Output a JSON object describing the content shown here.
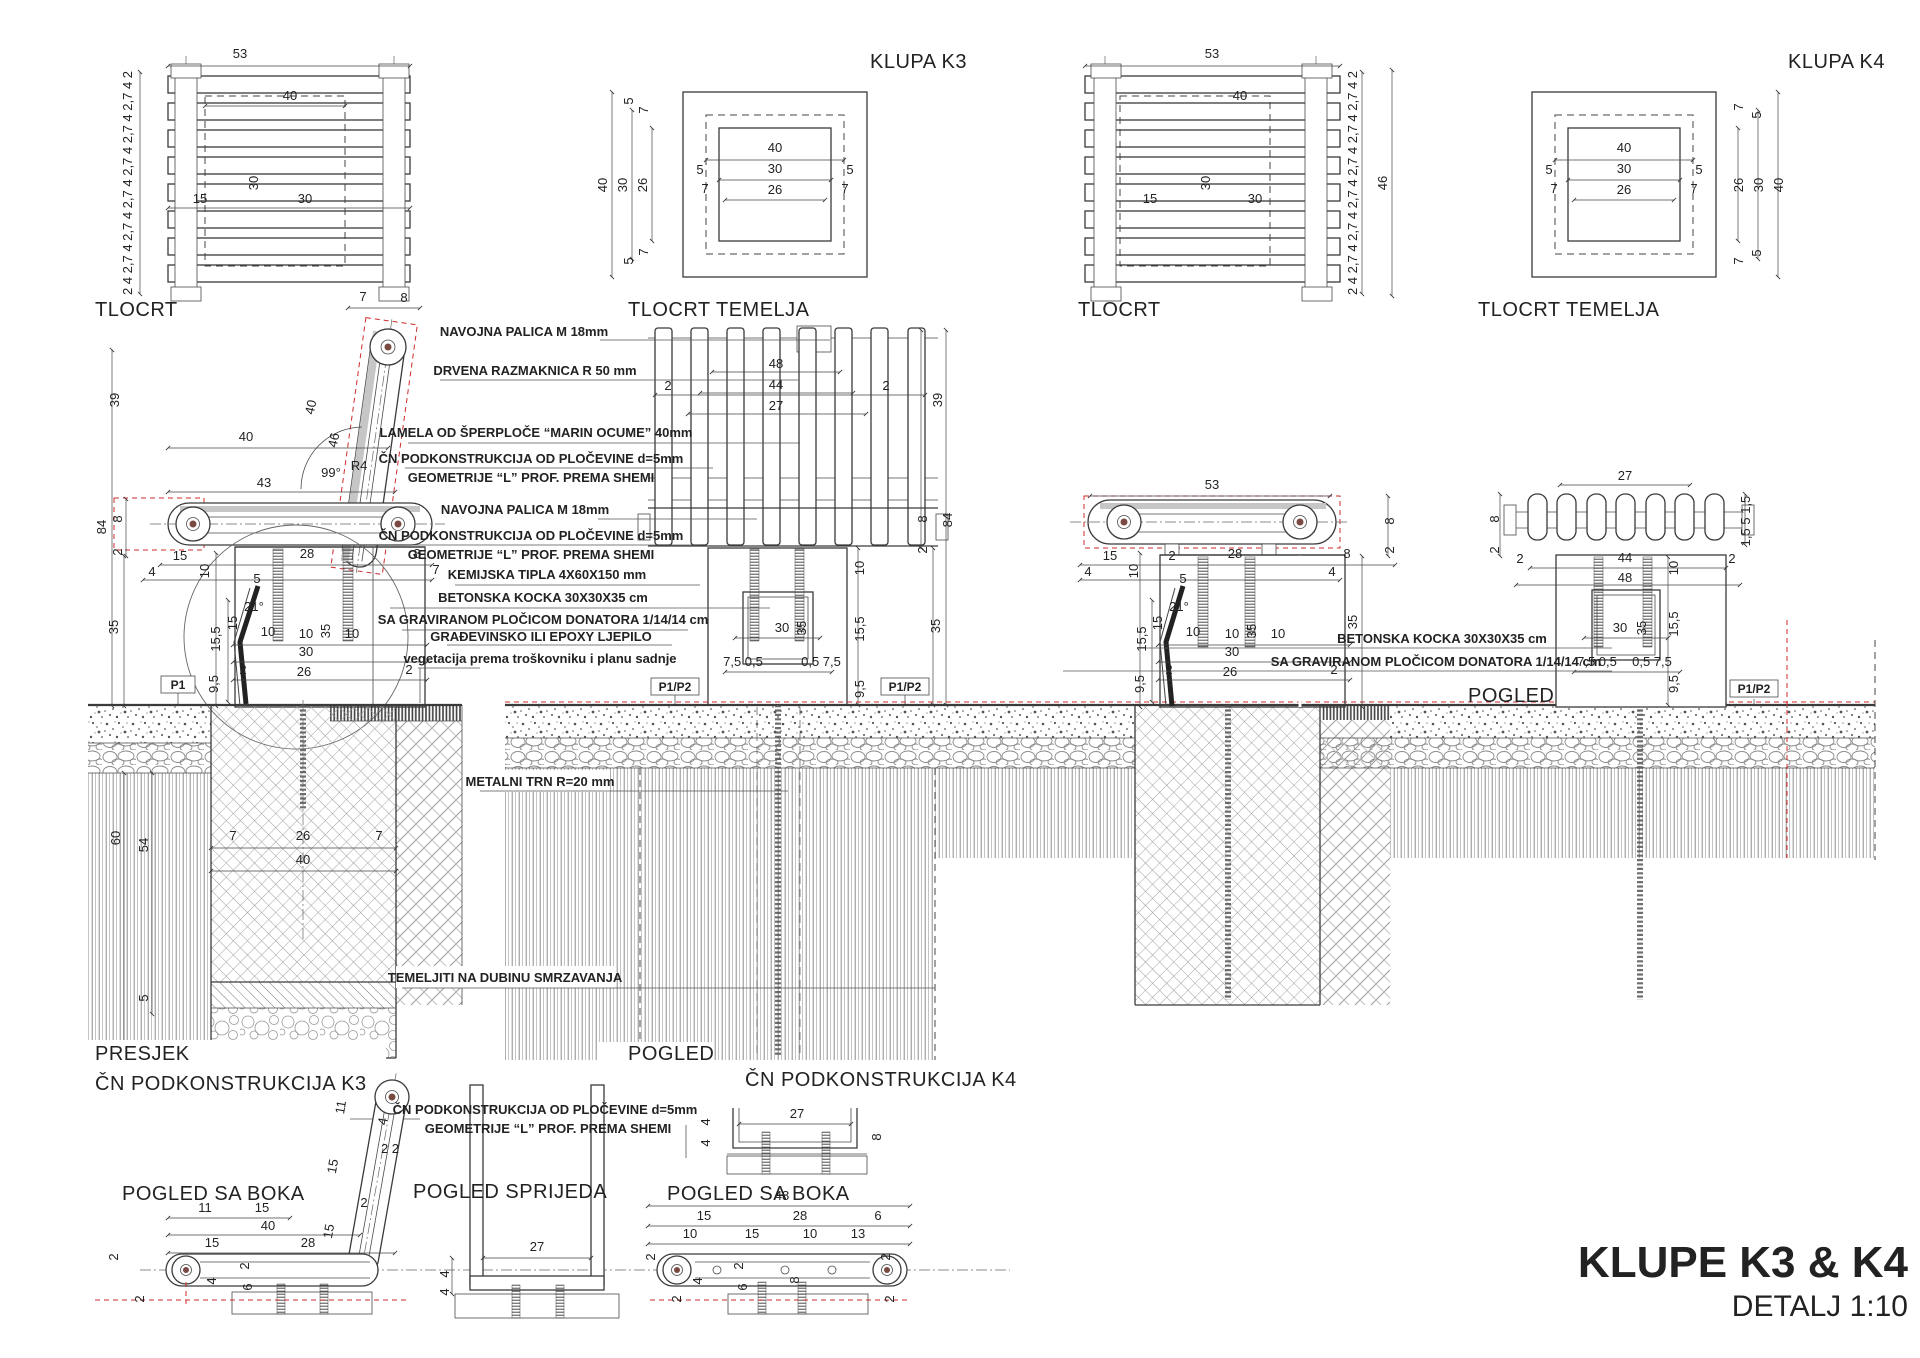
{
  "colors": {
    "line": "#3a3a3a",
    "red": "#cc2a2a",
    "pivot_dot": "#7a4a42",
    "hatch": "#8f8f8f"
  },
  "title_block": {
    "project": "KLUPE K3 & K4",
    "scale": "DETALJ 1:10"
  },
  "view_labels": {
    "k3_plan": "TLOCRT",
    "k3_foundation_plan": "TLOCRT TEMELJA",
    "k3_name": "KLUPA K3",
    "k4_plan": "TLOCRT",
    "k4_foundation_plan": "TLOCRT TEMELJA",
    "k4_name": "KLUPA K4",
    "k3_section": "PRESJEK",
    "k3_frame": "ČN PODKONSTRUKCIJA K3",
    "k3_front": "POGLED",
    "k4_frame": "ČN PODKONSTRUKCIJA K4",
    "k4_front": "POGLED",
    "k3_side": "POGLED SA BOKA",
    "frame_front": "POGLED SPRIJEDA",
    "k4_side": "POGLED SA BOKA"
  },
  "tags": {
    "p1": "P1",
    "p1p2": "P1/P2"
  },
  "annotations": {
    "navojna1": "NAVOJNA PALICA M 18mm",
    "drvena": "DRVENA RAZMAKNICA R 50 mm",
    "lamela": "LAMELA OD ŠPERPLOČE “MARIN OCUME” 40mm",
    "cn_ploc_1a": "ČN  PODKONSTRUKCIJA OD PLOČEVINE d=5mm",
    "cn_ploc_1b": "GEOMETRIJE “L” PROF. PREMA SHEMI",
    "navojna2": "NAVOJNA PALICA M 18mm",
    "cn_ploc_2a": "ČN  PODKONSTRUKCIJA OD PLOČEVINE d=5mm",
    "cn_ploc_2b": "GEOMETRIJE “L” PROF. PREMA SHEMI",
    "kemijska": "KEMIJSKA TIPLA 4X60X150 mm",
    "betonska": "BETONSKA KOCKA 30X30X35 cm",
    "gravirana": "SA GRAVIRANOM PLOČICOM DONATORA 1/14/14 cm",
    "ljepilo": "GRAĐEVINSKO ILI EPOXY LJEPILO",
    "vegetacija": "vegetacija prema troškovniku i planu sadnje",
    "metalni": "METALNI TRN R=20 mm",
    "temeljiti": "TEMELJITI NA DUBINU SMRZAVANJA",
    "cn_ploc_3a": "ČN  PODKONSTRUKCIJA OD PLOČEVINE d=5mm",
    "cn_ploc_3b": "GEOMETRIJE “L” PROF. PREMA SHEMI",
    "betonska2": "BETONSKA KOCKA 30X30X35 cm",
    "gravirana2": "SA GRAVIRANOM PLOČICOM DONATORA 1/14/14 cm"
  },
  "dim_texts": [
    {
      "t": "53",
      "x": 240,
      "y": 58
    },
    {
      "t": "2 4 2,7 4 2,7 4 2,7 4 2,7 4 2,7 4 2,7 4 2",
      "x": 132,
      "y": 183,
      "r": -90,
      "s": 10
    },
    {
      "t": "40",
      "x": 290,
      "y": 100
    },
    {
      "t": "30",
      "x": 258,
      "y": 183,
      "r": -90
    },
    {
      "t": "30",
      "x": 305,
      "y": 203
    },
    {
      "t": "15",
      "x": 200,
      "y": 203
    },
    {
      "t": "40",
      "x": 775,
      "y": 152
    },
    {
      "t": "30",
      "x": 775,
      "y": 173
    },
    {
      "t": "26",
      "x": 775,
      "y": 194
    },
    {
      "t": "5",
      "x": 700,
      "y": 174
    },
    {
      "t": "5",
      "x": 850,
      "y": 174
    },
    {
      "t": "7",
      "x": 705,
      "y": 193
    },
    {
      "t": "7",
      "x": 845,
      "y": 193
    },
    {
      "t": "40",
      "x": 607,
      "y": 185,
      "r": -90
    },
    {
      "t": "30",
      "x": 627,
      "y": 185,
      "r": -90
    },
    {
      "t": "26",
      "x": 647,
      "y": 185,
      "r": -90
    },
    {
      "t": "5",
      "x": 633,
      "y": 101,
      "r": -90
    },
    {
      "t": "7",
      "x": 648,
      "y": 110,
      "r": -90
    },
    {
      "t": "5",
      "x": 633,
      "y": 261,
      "r": -90
    },
    {
      "t": "7",
      "x": 648,
      "y": 252,
      "r": -90
    },
    {
      "t": "53",
      "x": 1212,
      "y": 58
    },
    {
      "t": "2 4 2,7 4 2,7 4 2,7 4 2,7 4 2,7 4 2,7 4 2",
      "x": 1357,
      "y": 183,
      "r": -90,
      "s": 10
    },
    {
      "t": "46",
      "x": 1387,
      "y": 183,
      "r": -90
    },
    {
      "t": "40",
      "x": 1240,
      "y": 100
    },
    {
      "t": "30",
      "x": 1210,
      "y": 183,
      "r": -90
    },
    {
      "t": "30",
      "x": 1255,
      "y": 203
    },
    {
      "t": "15",
      "x": 1150,
      "y": 203
    },
    {
      "t": "40",
      "x": 1624,
      "y": 152
    },
    {
      "t": "30",
      "x": 1624,
      "y": 173
    },
    {
      "t": "26",
      "x": 1624,
      "y": 194
    },
    {
      "t": "5",
      "x": 1549,
      "y": 174
    },
    {
      "t": "5",
      "x": 1699,
      "y": 174
    },
    {
      "t": "7",
      "x": 1554,
      "y": 193
    },
    {
      "t": "7",
      "x": 1694,
      "y": 193
    },
    {
      "t": "26",
      "x": 1743,
      "y": 185,
      "r": -90
    },
    {
      "t": "30",
      "x": 1763,
      "y": 185,
      "r": -90
    },
    {
      "t": "40",
      "x": 1783,
      "y": 185,
      "r": -90
    },
    {
      "t": "7",
      "x": 1743,
      "y": 107,
      "r": -90
    },
    {
      "t": "5",
      "x": 1761,
      "y": 115,
      "r": -90
    },
    {
      "t": "7",
      "x": 1743,
      "y": 261,
      "r": -90
    },
    {
      "t": "5",
      "x": 1761,
      "y": 253,
      "r": -90
    },
    {
      "t": "7",
      "x": 363,
      "y": 301
    },
    {
      "t": "8",
      "x": 404,
      "y": 302
    },
    {
      "t": "39",
      "x": 119,
      "y": 400,
      "r": -90
    },
    {
      "t": "40",
      "x": 246,
      "y": 441
    },
    {
      "t": "40",
      "x": 315,
      "y": 408,
      "r": -78
    },
    {
      "t": "46",
      "x": 338,
      "y": 441,
      "r": -78
    },
    {
      "t": "99°",
      "x": 331,
      "y": 477,
      "s": 11
    },
    {
      "t": "R4",
      "x": 359,
      "y": 470,
      "s": 11
    },
    {
      "t": "43",
      "x": 264,
      "y": 487
    },
    {
      "t": "84",
      "x": 106,
      "y": 527,
      "r": -90
    },
    {
      "t": "8",
      "x": 122,
      "y": 519,
      "r": -90
    },
    {
      "t": "2",
      "x": 122,
      "y": 552,
      "r": -90
    },
    {
      "t": "35",
      "x": 118,
      "y": 627,
      "r": -90
    },
    {
      "t": "15",
      "x": 180,
      "y": 560
    },
    {
      "t": "28",
      "x": 307,
      "y": 558
    },
    {
      "t": "8",
      "x": 417,
      "y": 558
    },
    {
      "t": "4",
      "x": 152,
      "y": 576
    },
    {
      "t": "10",
      "x": 209,
      "y": 571,
      "r": -90
    },
    {
      "t": "7",
      "x": 436,
      "y": 574
    },
    {
      "t": "5",
      "x": 257,
      "y": 583
    },
    {
      "t": "15,5",
      "x": 220,
      "y": 639,
      "r": -90
    },
    {
      "t": "15",
      "x": 237,
      "y": 623,
      "r": -90
    },
    {
      "t": "21°",
      "x": 254,
      "y": 611,
      "s": 11
    },
    {
      "t": "10",
      "x": 268,
      "y": 636
    },
    {
      "t": "10",
      "x": 306,
      "y": 638
    },
    {
      "t": "35",
      "x": 330,
      "y": 631,
      "r": -90
    },
    {
      "t": "10",
      "x": 352,
      "y": 638
    },
    {
      "t": "30",
      "x": 306,
      "y": 656
    },
    {
      "t": "26",
      "x": 304,
      "y": 676
    },
    {
      "t": "2",
      "x": 243,
      "y": 674
    },
    {
      "t": "2",
      "x": 409,
      "y": 674
    },
    {
      "t": "9,5",
      "x": 218,
      "y": 684,
      "r": -90
    },
    {
      "t": "7",
      "x": 233,
      "y": 840
    },
    {
      "t": "26",
      "x": 303,
      "y": 840
    },
    {
      "t": "7",
      "x": 379,
      "y": 840
    },
    {
      "t": "40",
      "x": 303,
      "y": 864
    },
    {
      "t": "60",
      "x": 120,
      "y": 838,
      "r": -90
    },
    {
      "t": "54",
      "x": 148,
      "y": 845,
      "r": -90
    },
    {
      "t": "5",
      "x": 148,
      "y": 998,
      "r": -90
    },
    {
      "t": "2",
      "x": 668,
      "y": 390
    },
    {
      "t": "2",
      "x": 886,
      "y": 390
    },
    {
      "t": "48",
      "x": 776,
      "y": 368
    },
    {
      "t": "44",
      "x": 776,
      "y": 389
    },
    {
      "t": "27",
      "x": 776,
      "y": 410
    },
    {
      "t": "39",
      "x": 942,
      "y": 400,
      "r": -90
    },
    {
      "t": "84",
      "x": 952,
      "y": 520,
      "r": -90
    },
    {
      "t": "8",
      "x": 927,
      "y": 519,
      "r": -90
    },
    {
      "t": "2",
      "x": 927,
      "y": 550,
      "r": -90
    },
    {
      "t": "35",
      "x": 940,
      "y": 626,
      "r": -90
    },
    {
      "t": "10",
      "x": 864,
      "y": 568,
      "r": -90
    },
    {
      "t": "15,5",
      "x": 864,
      "y": 629,
      "r": -90
    },
    {
      "t": "9,5",
      "x": 864,
      "y": 689,
      "r": -90
    },
    {
      "t": "30",
      "x": 782,
      "y": 632
    },
    {
      "t": "35",
      "x": 806,
      "y": 628,
      "r": -90
    },
    {
      "t": "7,5 0,5",
      "x": 743,
      "y": 666,
      "s": 11
    },
    {
      "t": "0,5 7,5",
      "x": 821,
      "y": 666,
      "s": 11
    },
    {
      "t": "53",
      "x": 1212,
      "y": 489
    },
    {
      "t": "8",
      "x": 1394,
      "y": 521,
      "r": -90
    },
    {
      "t": "2",
      "x": 1394,
      "y": 550,
      "r": -90
    },
    {
      "t": "15",
      "x": 1110,
      "y": 560
    },
    {
      "t": "2",
      "x": 1172,
      "y": 560
    },
    {
      "t": "28",
      "x": 1235,
      "y": 558
    },
    {
      "t": "8",
      "x": 1347,
      "y": 558
    },
    {
      "t": "4",
      "x": 1088,
      "y": 576
    },
    {
      "t": "10",
      "x": 1138,
      "y": 571,
      "r": -90
    },
    {
      "t": "5",
      "x": 1183,
      "y": 583
    },
    {
      "t": "4",
      "x": 1332,
      "y": 576
    },
    {
      "t": "15,5",
      "x": 1146,
      "y": 639,
      "r": -90
    },
    {
      "t": "15",
      "x": 1162,
      "y": 623,
      "r": -90
    },
    {
      "t": "21°",
      "x": 1179,
      "y": 611,
      "s": 11
    },
    {
      "t": "10",
      "x": 1193,
      "y": 636
    },
    {
      "t": "10",
      "x": 1232,
      "y": 638
    },
    {
      "t": "35",
      "x": 1256,
      "y": 631,
      "r": -90
    },
    {
      "t": "10",
      "x": 1278,
      "y": 638
    },
    {
      "t": "30",
      "x": 1232,
      "y": 656
    },
    {
      "t": "26",
      "x": 1230,
      "y": 676
    },
    {
      "t": "2",
      "x": 1169,
      "y": 674
    },
    {
      "t": "2",
      "x": 1334,
      "y": 674
    },
    {
      "t": "9,5",
      "x": 1144,
      "y": 684,
      "r": -90
    },
    {
      "t": "35",
      "x": 1357,
      "y": 622,
      "r": -90
    },
    {
      "t": "27",
      "x": 1625,
      "y": 480
    },
    {
      "t": "8",
      "x": 1499,
      "y": 519,
      "r": -90
    },
    {
      "t": "2",
      "x": 1499,
      "y": 550,
      "r": -90
    },
    {
      "t": "1,5 5 1,5",
      "x": 1750,
      "y": 521,
      "r": -90,
      "s": 10
    },
    {
      "t": "2",
      "x": 1520,
      "y": 563
    },
    {
      "t": "2",
      "x": 1732,
      "y": 563
    },
    {
      "t": "44",
      "x": 1625,
      "y": 562
    },
    {
      "t": "48",
      "x": 1625,
      "y": 582
    },
    {
      "t": "10",
      "x": 1678,
      "y": 568,
      "r": -90
    },
    {
      "t": "30",
      "x": 1620,
      "y": 632
    },
    {
      "t": "35",
      "x": 1646,
      "y": 628,
      "r": -90
    },
    {
      "t": "15,5",
      "x": 1678,
      "y": 624,
      "r": -90
    },
    {
      "t": "7,5 0,5",
      "x": 1597,
      "y": 666,
      "s": 11
    },
    {
      "t": "0,5 7,5",
      "x": 1652,
      "y": 666,
      "s": 11
    },
    {
      "t": "9,5",
      "x": 1678,
      "y": 684,
      "r": -90
    },
    {
      "t": "11",
      "x": 345,
      "y": 1108,
      "r": -80
    },
    {
      "t": "4",
      "x": 387,
      "y": 1122,
      "r": -80
    },
    {
      "t": "2 2",
      "x": 390,
      "y": 1153,
      "s": 11
    },
    {
      "t": "15",
      "x": 337,
      "y": 1167,
      "r": -80
    },
    {
      "t": "2",
      "x": 364,
      "y": 1207
    },
    {
      "t": "11",
      "x": 205,
      "y": 1212
    },
    {
      "t": "15",
      "x": 262,
      "y": 1212
    },
    {
      "t": "40",
      "x": 268,
      "y": 1230
    },
    {
      "t": "15",
      "x": 212,
      "y": 1247
    },
    {
      "t": "28",
      "x": 308,
      "y": 1247
    },
    {
      "t": "15",
      "x": 333,
      "y": 1232,
      "r": -80
    },
    {
      "t": "2",
      "x": 118,
      "y": 1257,
      "r": -90
    },
    {
      "t": "2",
      "x": 144,
      "y": 1299,
      "r": -90
    },
    {
      "t": "4",
      "x": 216,
      "y": 1281,
      "r": -90
    },
    {
      "t": "6",
      "x": 252,
      "y": 1287,
      "r": -90
    },
    {
      "t": "2",
      "x": 249,
      "y": 1266,
      "r": -90
    },
    {
      "t": "27",
      "x": 537,
      "y": 1251
    },
    {
      "t": "4",
      "x": 449,
      "y": 1274,
      "r": -90
    },
    {
      "t": "4",
      "x": 449,
      "y": 1292,
      "r": -90
    },
    {
      "t": "27",
      "x": 797,
      "y": 1118
    },
    {
      "t": "4",
      "x": 710,
      "y": 1122,
      "r": -90
    },
    {
      "t": "4",
      "x": 710,
      "y": 1143,
      "r": -90
    },
    {
      "t": "8",
      "x": 881,
      "y": 1137,
      "r": -90
    },
    {
      "t": "48",
      "x": 782,
      "y": 1200
    },
    {
      "t": "15",
      "x": 704,
      "y": 1220
    },
    {
      "t": "28",
      "x": 800,
      "y": 1220
    },
    {
      "t": "6",
      "x": 878,
      "y": 1220
    },
    {
      "t": "10",
      "x": 690,
      "y": 1238
    },
    {
      "t": "15",
      "x": 752,
      "y": 1238
    },
    {
      "t": "10",
      "x": 810,
      "y": 1238
    },
    {
      "t": "13",
      "x": 858,
      "y": 1238
    },
    {
      "t": "2",
      "x": 655,
      "y": 1257,
      "r": -90
    },
    {
      "t": "2",
      "x": 681,
      "y": 1299,
      "r": -90
    },
    {
      "t": "4",
      "x": 702,
      "y": 1281,
      "r": -90
    },
    {
      "t": "6",
      "x": 747,
      "y": 1287,
      "r": -90
    },
    {
      "t": "2",
      "x": 743,
      "y": 1266,
      "r": -90
    },
    {
      "t": "8",
      "x": 799,
      "y": 1280,
      "r": -90
    },
    {
      "t": "2",
      "x": 890,
      "y": 1257,
      "r": -90
    },
    {
      "t": "2",
      "x": 894,
      "y": 1299,
      "r": -90
    }
  ]
}
